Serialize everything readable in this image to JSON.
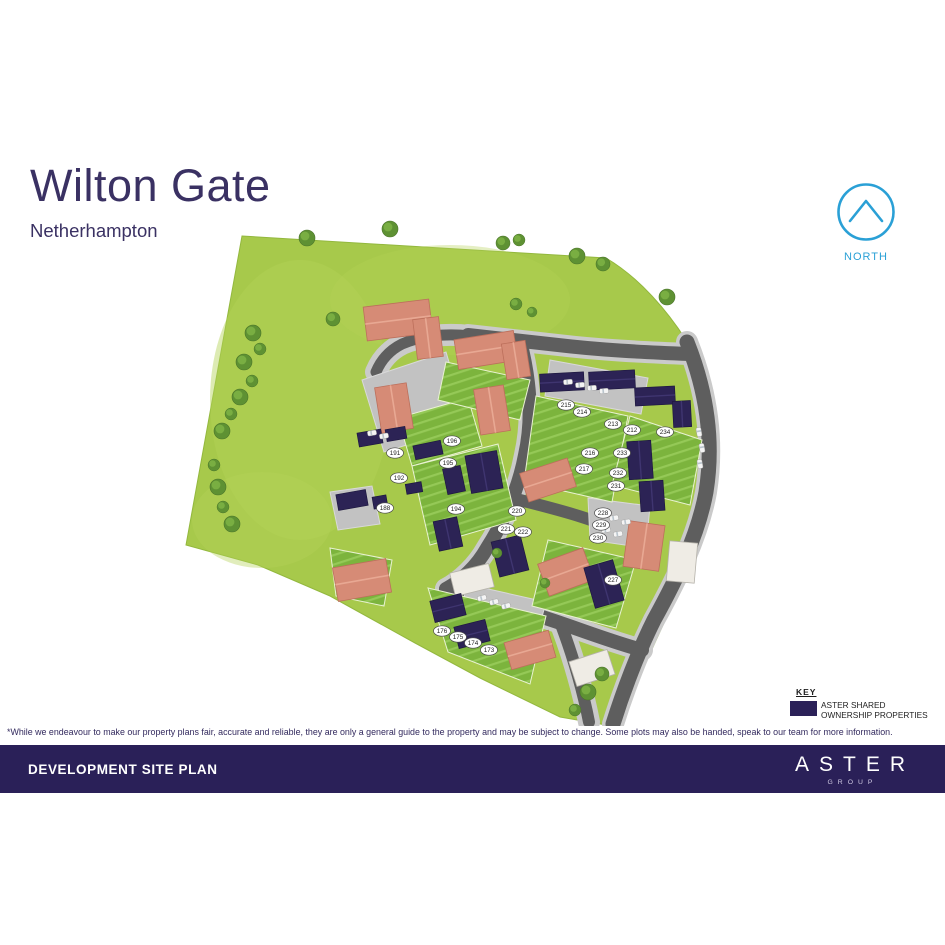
{
  "header": {
    "title": "Wilton Gate",
    "subtitle": "Netherhampton"
  },
  "north": {
    "label": "NORTH",
    "color": "#2aa0d6"
  },
  "key": {
    "title": "KEY",
    "swatch_color": "#2b2158",
    "label_line1": "ASTER SHARED",
    "label_line2": "OWNERSHIP PROPERTIES"
  },
  "disclaimer": "*While we endeavour to make our property plans fair, accurate and reliable, they are only a general guide to the property and may be subject to change. Some plots may also be handed, speak to our team for more information.",
  "footer": {
    "title": "DEVELOPMENT SITE PLAN",
    "brand_name": "ASTER",
    "brand_sub": "GROUP"
  },
  "site_plan": {
    "colors": {
      "field_green": "#a7c94b",
      "garden_green": "#7cb43d",
      "road_grey": "#5e5e5e",
      "pavement_grey": "#cacaca",
      "courtyard_grey": "#c2c2c2",
      "shared_ownership_navy": "#2c2355",
      "market_home_roof": "#d68b76",
      "tree_green": "#5e9133"
    },
    "plots": [
      {
        "n": "173",
        "x": 489,
        "y": 650
      },
      {
        "n": "174",
        "x": 473,
        "y": 643
      },
      {
        "n": "175",
        "x": 458,
        "y": 637
      },
      {
        "n": "176",
        "x": 442,
        "y": 631
      },
      {
        "n": "188",
        "x": 385,
        "y": 508
      },
      {
        "n": "191",
        "x": 395,
        "y": 453
      },
      {
        "n": "192",
        "x": 399,
        "y": 478
      },
      {
        "n": "194",
        "x": 456,
        "y": 509
      },
      {
        "n": "195",
        "x": 448,
        "y": 463
      },
      {
        "n": "196",
        "x": 452,
        "y": 441
      },
      {
        "n": "212",
        "x": 632,
        "y": 430
      },
      {
        "n": "213",
        "x": 613,
        "y": 424
      },
      {
        "n": "214",
        "x": 582,
        "y": 412
      },
      {
        "n": "215",
        "x": 566,
        "y": 405
      },
      {
        "n": "216",
        "x": 590,
        "y": 453
      },
      {
        "n": "217",
        "x": 584,
        "y": 469
      },
      {
        "n": "220",
        "x": 517,
        "y": 511
      },
      {
        "n": "221",
        "x": 506,
        "y": 529
      },
      {
        "n": "222",
        "x": 523,
        "y": 532
      },
      {
        "n": "227",
        "x": 613,
        "y": 580
      },
      {
        "n": "228",
        "x": 603,
        "y": 513
      },
      {
        "n": "229",
        "x": 601,
        "y": 525
      },
      {
        "n": "230",
        "x": 598,
        "y": 538
      },
      {
        "n": "231",
        "x": 616,
        "y": 486
      },
      {
        "n": "232",
        "x": 618,
        "y": 473
      },
      {
        "n": "233",
        "x": 622,
        "y": 453
      },
      {
        "n": "234",
        "x": 665,
        "y": 432
      }
    ],
    "trees": [
      [
        307,
        238,
        8
      ],
      [
        390,
        229,
        8
      ],
      [
        503,
        243,
        7
      ],
      [
        519,
        240,
        6
      ],
      [
        577,
        256,
        8
      ],
      [
        603,
        264,
        7
      ],
      [
        667,
        297,
        8
      ],
      [
        253,
        333,
        8
      ],
      [
        260,
        349,
        6
      ],
      [
        244,
        362,
        8
      ],
      [
        252,
        381,
        6
      ],
      [
        240,
        397,
        8
      ],
      [
        231,
        414,
        6
      ],
      [
        222,
        431,
        8
      ],
      [
        214,
        465,
        6
      ],
      [
        218,
        487,
        8
      ],
      [
        223,
        507,
        6
      ],
      [
        232,
        524,
        8
      ],
      [
        333,
        319,
        7
      ],
      [
        516,
        304,
        6
      ],
      [
        532,
        312,
        5
      ],
      [
        588,
        692,
        8
      ],
      [
        602,
        674,
        7
      ],
      [
        575,
        710,
        6
      ],
      [
        497,
        553,
        5
      ],
      [
        545,
        583,
        5
      ]
    ],
    "cars": [
      [
        568,
        382,
        -5
      ],
      [
        580,
        385,
        -5
      ],
      [
        592,
        388,
        -5
      ],
      [
        604,
        391,
        -5
      ],
      [
        699,
        432,
        80
      ],
      [
        702,
        448,
        80
      ],
      [
        700,
        464,
        80
      ],
      [
        602,
        514,
        -10
      ],
      [
        614,
        518,
        -10
      ],
      [
        626,
        522,
        -10
      ],
      [
        606,
        530,
        -10
      ],
      [
        618,
        534,
        -10
      ],
      [
        482,
        598,
        -14
      ],
      [
        494,
        602,
        -14
      ],
      [
        506,
        606,
        -14
      ],
      [
        372,
        433,
        -10
      ],
      [
        384,
        436,
        -10
      ]
    ]
  }
}
